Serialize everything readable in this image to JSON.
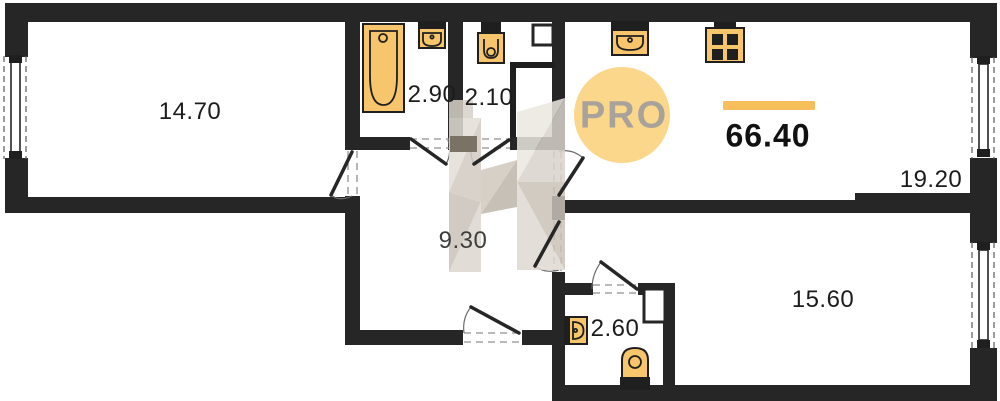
{
  "plan": {
    "watermark_logo": "PRO",
    "watermark_letter": "H",
    "total_area": "66.40",
    "rooms": {
      "living": {
        "area": "14.70"
      },
      "bathroom": {
        "area": "2.90"
      },
      "wc": {
        "area": "2.10"
      },
      "hallway": {
        "area": "9.30"
      },
      "kitchen_living": {
        "area": "19.20"
      },
      "bedroom": {
        "area": "15.60"
      },
      "wc_2": {
        "area": "2.60"
      }
    },
    "fixtures": [
      "bathtub",
      "sink",
      "toilet",
      "kitchen-sink",
      "stove",
      "sink",
      "toilet"
    ],
    "colors": {
      "wall": "#262626",
      "ink": "#1f1f1f",
      "fixture_fill": "#F6C56C",
      "accent_bar": "#F7BE5C",
      "logo_circle": "#FBD78C",
      "logo_text": "#A9A29B",
      "watermark": "#D8D2C9"
    }
  }
}
